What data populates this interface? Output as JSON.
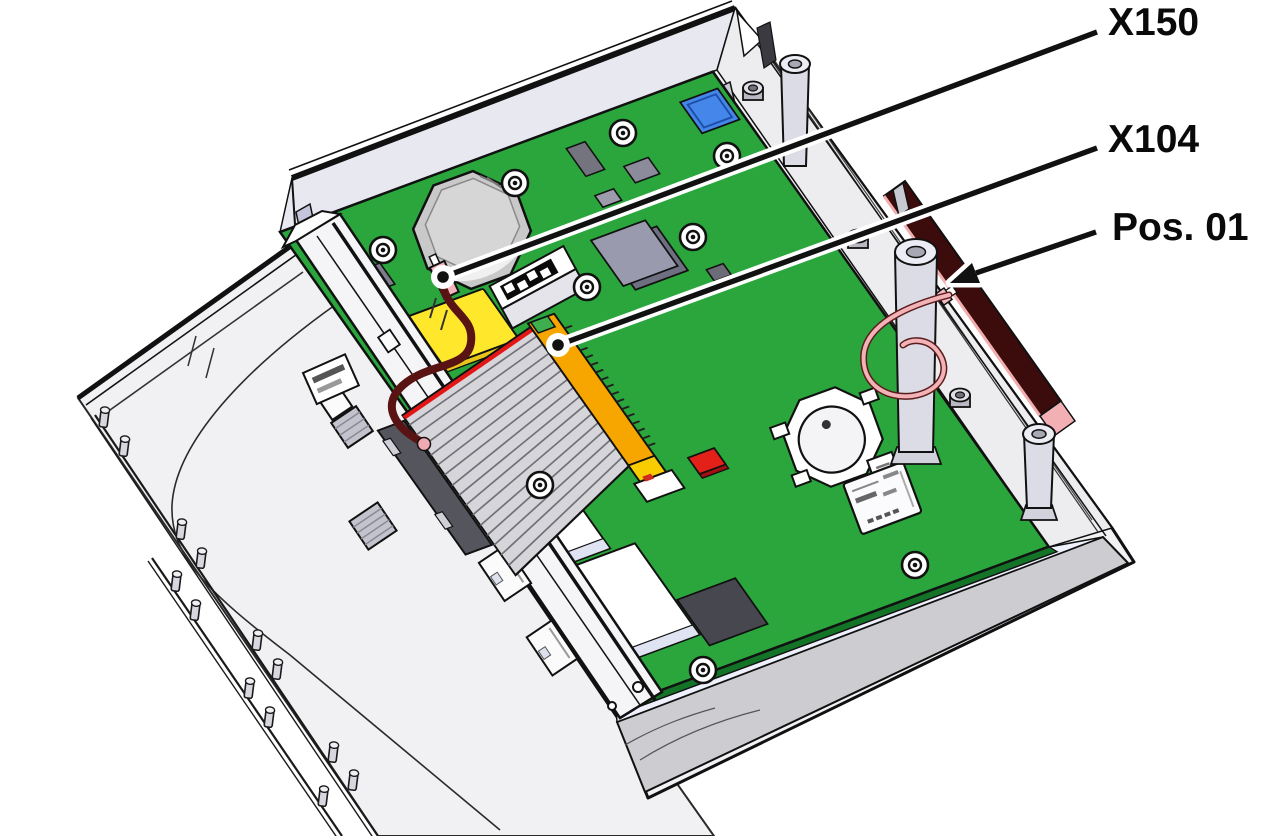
{
  "figure": {
    "type": "technical-illustration",
    "subject": "Device enclosure opened with lid folded out, main circuit board exposed",
    "background_color": "#ffffff"
  },
  "callouts": [
    {
      "label": "X150",
      "target": "board-connector-x150-with-dark-red-wire",
      "pointer": "dot"
    },
    {
      "label": "X104",
      "target": "orange-card-edge-connector-x104",
      "pointer": "dot"
    },
    {
      "label": "Pos. 01",
      "target": "antenna-strip-on-side-wall",
      "pointer": "arrow"
    }
  ],
  "colors": {
    "pcb": "#2aa63c",
    "pcb_edge": "#137428",
    "callout_line": "#111111",
    "callout_halo": "#ffffff",
    "antenna": "#3c0b0b",
    "antenna_trim": "#f2aeae",
    "ribbon_stripe": "#e31515",
    "x104_connector": "#f7a600",
    "x150_connector": "#f5b3bc",
    "dark_red_wire": "#5a1313",
    "pink_wire": "#f2b2b6",
    "yellow_pad": "#ffe72b",
    "chip_blue": "#4486ea",
    "chip_red": "#e32119",
    "case": "#f2f2f5",
    "lid": "#f1f1f3"
  },
  "components": [
    "enclosure-lid",
    "lid-peg-rails",
    "enclosure-base",
    "front-panel-with-port-cutouts",
    "main-board",
    "buzzer",
    "dip-switch",
    "ribbon-cable",
    "connector-x150",
    "connector-x104",
    "coin-cell-holder",
    "micro-sd-slot",
    "antenna-strip",
    "standoff-posts",
    "hex-nuts",
    "screws",
    "ethernet-housings",
    "usb-connector",
    "blue-chip",
    "red-component",
    "dark-chip"
  ]
}
